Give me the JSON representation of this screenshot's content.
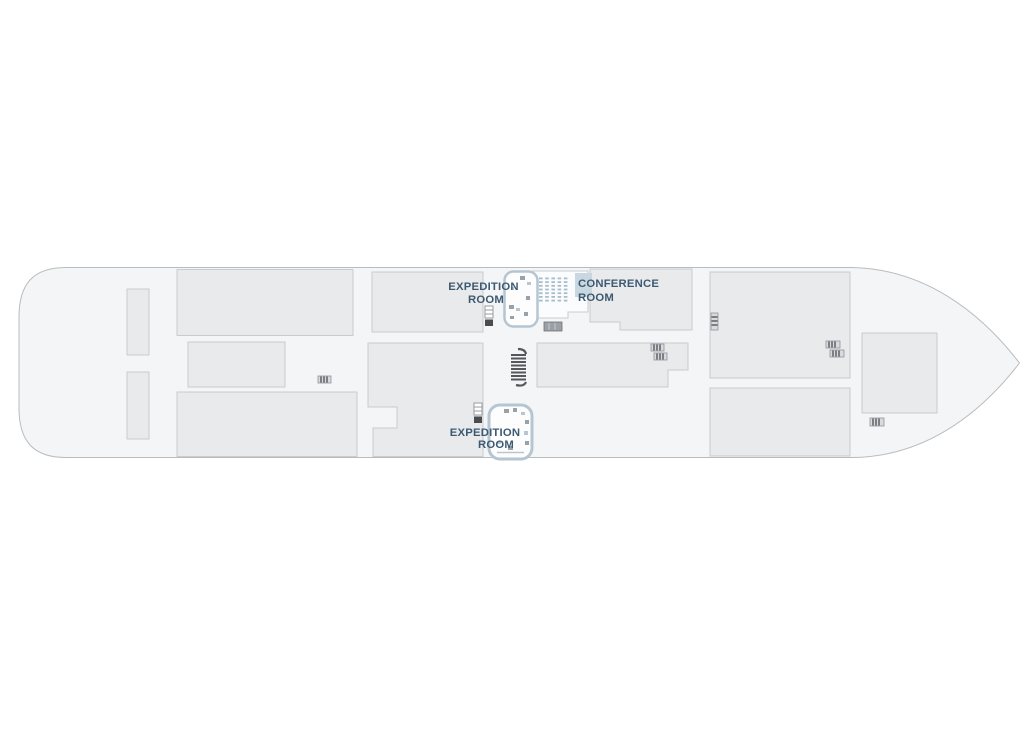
{
  "page": {
    "title": "Ship deck plan"
  },
  "colors": {
    "page_bg": "#ffffff",
    "hull_fill": "#f4f5f6",
    "hull_stroke": "#b9bcbe",
    "room_fill": "#e8eaeb",
    "room_stroke": "#c9cccf",
    "accent_text": "#3d5a73",
    "exp_border": "#b5c6d2",
    "seat": "#a7bdcb",
    "screen": "#c9d7e0"
  },
  "labels": {
    "expedition_top": {
      "line1": "EXPEDITION",
      "line2": "ROOM"
    },
    "conference": {
      "line1": "CONFERENCE",
      "line2": "ROOM"
    },
    "expedition_bottom": {
      "line1": "EXPEDITION",
      "line2": "ROOM"
    }
  },
  "conference_seating": {
    "rows": 7,
    "cols": 5
  }
}
